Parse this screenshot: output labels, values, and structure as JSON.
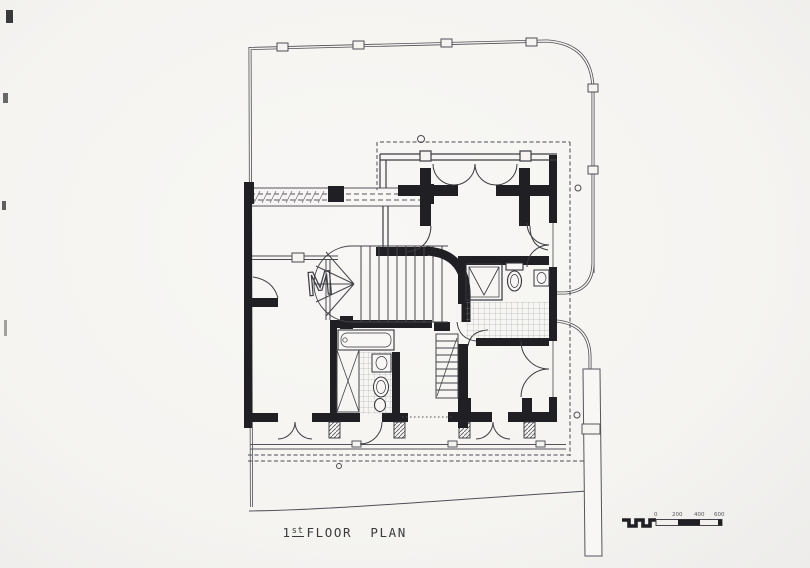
{
  "title": {
    "number": "1",
    "ordinal": "st",
    "words": "FLOOR  PLAN",
    "full": "1st FLOOR PLAN"
  },
  "scale_bar": {
    "labels": [
      "0",
      "200",
      "400",
      "600"
    ]
  },
  "annotations": {
    "material_break": "M"
  },
  "colors": {
    "paper": "#f5f4f1",
    "ink": "#202024",
    "boundary_line": "#4e4e55",
    "light_line": "#8a8a90"
  }
}
